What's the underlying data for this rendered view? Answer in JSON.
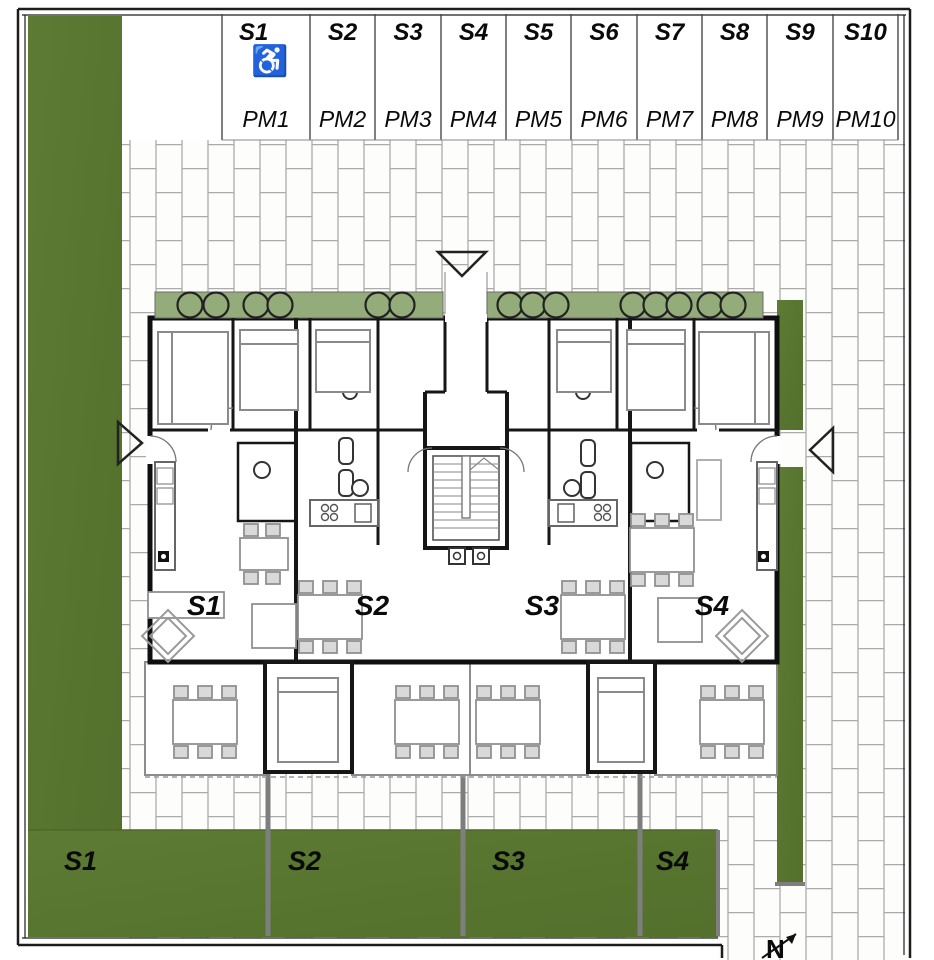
{
  "parking": {
    "accessible_icon": "♿",
    "stalls": [
      {
        "space": "S1",
        "pm": "PM1",
        "accessible": true
      },
      {
        "space": "S2",
        "pm": "PM2",
        "accessible": false
      },
      {
        "space": "S3",
        "pm": "PM3",
        "accessible": false
      },
      {
        "space": "S4",
        "pm": "PM4",
        "accessible": false
      },
      {
        "space": "S5",
        "pm": "PM5",
        "accessible": false
      },
      {
        "space": "S6",
        "pm": "PM6",
        "accessible": false
      },
      {
        "space": "S7",
        "pm": "PM7",
        "accessible": false
      },
      {
        "space": "S8",
        "pm": "PM8",
        "accessible": false
      },
      {
        "space": "S9",
        "pm": "PM9",
        "accessible": false
      },
      {
        "space": "S10",
        "pm": "PM10",
        "accessible": false
      }
    ]
  },
  "building": {
    "units": [
      {
        "label": "S1"
      },
      {
        "label": "S2"
      },
      {
        "label": "S3"
      },
      {
        "label": "S4"
      }
    ]
  },
  "gardens": {
    "plots": [
      {
        "label": "S1"
      },
      {
        "label": "S2"
      },
      {
        "label": "S3"
      },
      {
        "label": "S4"
      }
    ]
  },
  "compass": {
    "north_label": "N"
  },
  "colors": {
    "grass": "#5a7731",
    "planter": "#93ac7a",
    "wall": "#111111",
    "paver_joint": "#ababab",
    "divider_gray": "#7e7e7e",
    "furniture_gray": "#9a9a9a"
  }
}
